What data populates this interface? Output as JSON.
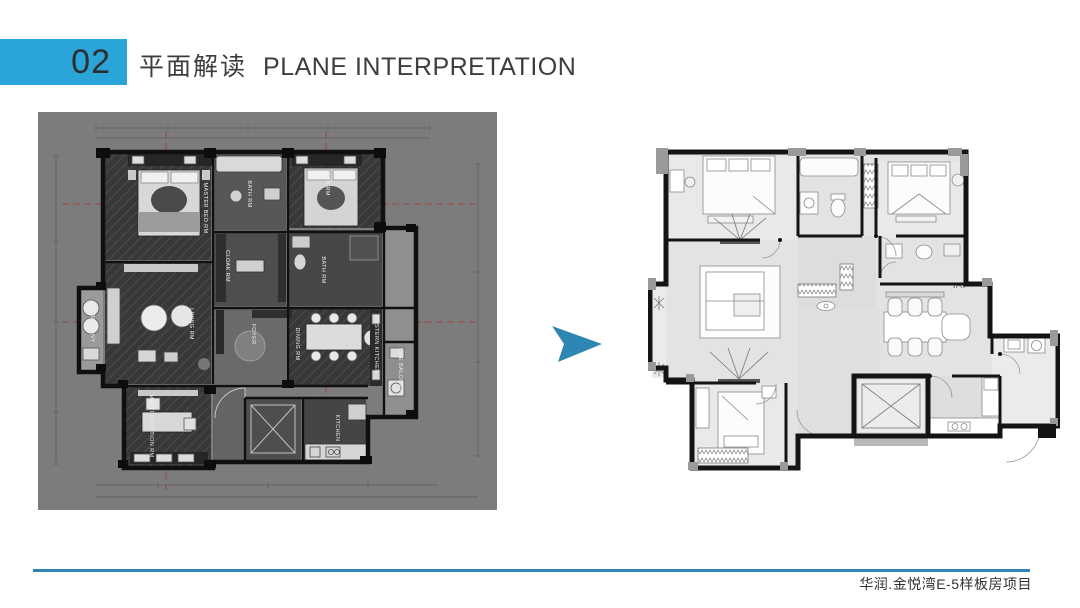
{
  "header": {
    "number": "02",
    "title_zh": "平面解读",
    "title_en": "PLANE INTERPRETATION"
  },
  "footer": {
    "project": "华润.金悦湾E-5样板房项目"
  },
  "colors": {
    "accent": "#2BA5D8",
    "arrow": "#2E87B2",
    "footer_line": "#2E87B2",
    "left_plan_background": "#7C7C7C"
  },
  "left_plan": {
    "rooms": [
      {
        "label": "MASTER BED RM"
      },
      {
        "label": "BATH RM"
      },
      {
        "label": "BED RM"
      },
      {
        "label": "CLOAK RM"
      },
      {
        "label": "BATH RM"
      },
      {
        "label": "LIVING RM"
      },
      {
        "label": "BALCONY"
      },
      {
        "label": "DINING RM"
      },
      {
        "label": "WESTERN KITCHEN"
      },
      {
        "label": "FOYER"
      },
      {
        "label": "KITCHEN"
      },
      {
        "label": "LIFE BALCONY"
      },
      {
        "label": "MULTI FUNCTION RM"
      }
    ]
  }
}
